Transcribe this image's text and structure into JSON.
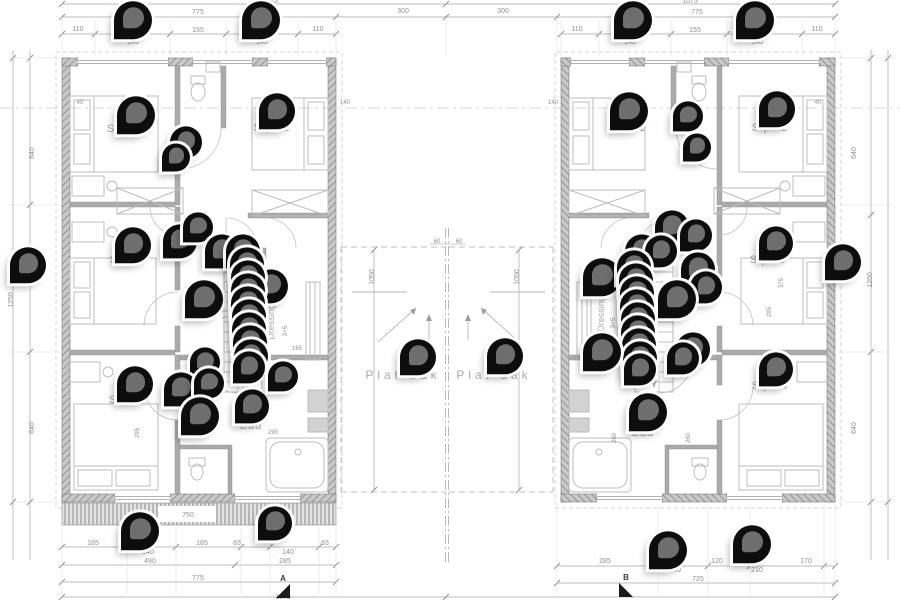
{
  "drawing": {
    "type_label": "first-floor plan, two mirrored dwelling units",
    "colors": {
      "pin_body": "#0d0d0d",
      "pin_inner": "#6e6e6e",
      "wall": "#a8a8a8",
      "dim_text": "#8f8f8f"
    }
  },
  "texts": [
    {
      "x": 270,
      "y": 3,
      "t": "1075",
      "n": "dim-total-left"
    },
    {
      "x": 690,
      "y": 3,
      "t": "1075",
      "n": "dim-total-right"
    },
    {
      "x": 198,
      "y": 14,
      "t": "775"
    },
    {
      "x": 403,
      "y": 13,
      "t": "300"
    },
    {
      "x": 503,
      "y": 13,
      "t": "300"
    },
    {
      "x": 697,
      "y": 14,
      "t": "775"
    },
    {
      "x": 78,
      "y": 31,
      "t": "110"
    },
    {
      "x": 198,
      "y": 32,
      "t": "155"
    },
    {
      "x": 318,
      "y": 31,
      "t": "110"
    },
    {
      "x": 133,
      "y": 44,
      "t": "140"
    },
    {
      "x": 262,
      "y": 44,
      "t": "140"
    },
    {
      "x": 577,
      "y": 31,
      "t": "110"
    },
    {
      "x": 695,
      "y": 32,
      "t": "155"
    },
    {
      "x": 817,
      "y": 31,
      "t": "110"
    },
    {
      "x": 630,
      "y": 44,
      "t": "140"
    },
    {
      "x": 757,
      "y": 44,
      "t": "140"
    },
    {
      "x": 80,
      "y": 104,
      "t": "40",
      "s": 6
    },
    {
      "x": 345,
      "y": 104,
      "t": "140",
      "s": 6
    },
    {
      "x": 553,
      "y": 104,
      "t": "140",
      "s": 6
    },
    {
      "x": 818,
      "y": 104,
      "t": "40",
      "s": 6
    },
    {
      "x": 437,
      "y": 243,
      "t": "60",
      "s": 6
    },
    {
      "x": 459,
      "y": 243,
      "t": "60",
      "s": 6
    },
    {
      "x": 125,
      "y": 132,
      "t": "Slpk.2",
      "s": 11,
      "ls": 1,
      "c": "#a9a9a9",
      "n": "room-label-slpk2-left"
    },
    {
      "x": 272,
      "y": 131,
      "t": "Slpk.1",
      "s": 11,
      "ls": 1,
      "c": "#a9a9a9",
      "n": "room-label-slpk1-left"
    },
    {
      "x": 128,
      "y": 263,
      "t": "Slpk.3",
      "s": 11,
      "ls": 1,
      "c": "#a9a9a9",
      "n": "room-label-slpk3-left"
    },
    {
      "x": 127,
      "y": 403,
      "t": "Slpk.4",
      "s": 11,
      "ls": 1,
      "c": "#a9a9a9",
      "n": "room-label-slpk4-left"
    },
    {
      "x": 251,
      "y": 429,
      "t": "Bad",
      "s": 11,
      "ls": 1,
      "c": "#a9a9a9",
      "n": "room-label-bad-left"
    },
    {
      "x": 274,
      "y": 322,
      "t": "Dressing",
      "s": 9,
      "r": -90,
      "c": "#a9a9a9",
      "n": "room-label-dressing-left"
    },
    {
      "x": 287,
      "y": 331,
      "t": "3+5",
      "s": 6.5,
      "r": -90
    },
    {
      "x": 628,
      "y": 131,
      "t": "Slpk.1",
      "s": 11,
      "ls": 1,
      "c": "#a9a9a9",
      "n": "room-label-slpk1-right"
    },
    {
      "x": 770,
      "y": 131,
      "t": "Slpk.2",
      "s": 11,
      "ls": 1,
      "c": "#a9a9a9",
      "n": "room-label-slpk2-right"
    },
    {
      "x": 768,
      "y": 263,
      "t": "Slpk.3",
      "s": 11,
      "ls": 1,
      "c": "#a9a9a9",
      "n": "room-label-slpk3-right"
    },
    {
      "x": 770,
      "y": 389,
      "t": "Slpk.4",
      "s": 11,
      "ls": 1,
      "c": "#a9a9a9",
      "n": "room-label-slpk4-right"
    },
    {
      "x": 643,
      "y": 436,
      "t": "Bad",
      "s": 11,
      "ls": 1,
      "c": "#a9a9a9",
      "n": "room-label-bad-right"
    },
    {
      "x": 604,
      "y": 314,
      "t": "Dressing",
      "s": 9,
      "r": -90,
      "c": "#a9a9a9",
      "n": "room-label-dressing-right"
    },
    {
      "x": 615,
      "y": 323,
      "t": "3+5",
      "s": 6.5,
      "r": -90
    },
    {
      "x": 403,
      "y": 379,
      "t": "Plat dak",
      "s": 12,
      "ls": 4,
      "c": "#ababab",
      "n": "flat-roof-label-left"
    },
    {
      "x": 494,
      "y": 379,
      "t": "Plat dak",
      "s": 12,
      "ls": 4,
      "c": "#ababab",
      "n": "flat-roof-label-right"
    },
    {
      "x": 188,
      "y": 517,
      "t": "750",
      "s": 7
    },
    {
      "x": 93,
      "y": 545,
      "t": "185"
    },
    {
      "x": 148,
      "y": 554,
      "t": "140"
    },
    {
      "x": 202,
      "y": 545,
      "t": "185"
    },
    {
      "x": 237,
      "y": 545,
      "t": "83"
    },
    {
      "x": 288,
      "y": 554,
      "t": "140"
    },
    {
      "x": 325,
      "y": 545,
      "t": "83"
    },
    {
      "x": 150,
      "y": 563,
      "t": "490"
    },
    {
      "x": 285,
      "y": 563,
      "t": "285"
    },
    {
      "x": 198,
      "y": 580,
      "t": "775"
    },
    {
      "x": 605,
      "y": 563,
      "t": "285"
    },
    {
      "x": 675,
      "y": 572,
      "t": "140"
    },
    {
      "x": 717,
      "y": 563,
      "t": "120"
    },
    {
      "x": 757,
      "y": 572,
      "t": "210"
    },
    {
      "x": 806,
      "y": 563,
      "t": "170"
    },
    {
      "x": 698,
      "y": 581,
      "t": "725"
    },
    {
      "x": 283,
      "y": 599,
      "t": "1075"
    },
    {
      "x": 13,
      "y": 300,
      "t": "1250",
      "r": -90
    },
    {
      "x": 34,
      "y": 153,
      "t": "640",
      "r": -90
    },
    {
      "x": 34,
      "y": 428,
      "t": "640",
      "r": -90
    },
    {
      "x": 872,
      "y": 280,
      "t": "1250",
      "r": -90
    },
    {
      "x": 856,
      "y": 153,
      "t": "640",
      "r": -90
    },
    {
      "x": 856,
      "y": 428,
      "t": "640",
      "r": -90
    },
    {
      "x": 374,
      "y": 277,
      "t": "1050",
      "r": -90
    },
    {
      "x": 519,
      "y": 277,
      "t": "1050",
      "r": -90
    },
    {
      "x": 139,
      "y": 433,
      "t": "295",
      "r": -90,
      "s": 6
    },
    {
      "x": 771,
      "y": 312,
      "t": "295",
      "r": -90,
      "s": 6
    },
    {
      "x": 783,
      "y": 283,
      "t": "375",
      "r": -90,
      "s": 6
    },
    {
      "x": 616,
      "y": 438,
      "t": "260",
      "r": -90,
      "s": 6
    },
    {
      "x": 690,
      "y": 438,
      "t": "260",
      "r": -90,
      "s": 6
    },
    {
      "x": 297,
      "y": 350,
      "t": "165",
      "s": 6
    },
    {
      "x": 273,
      "y": 434,
      "t": "290",
      "s": 6
    },
    {
      "x": 642,
      "y": 398,
      "t": "390",
      "s": 6
    }
  ],
  "sections": [
    {
      "label": "A",
      "x": 283,
      "y": 581,
      "tri": "290,584 290,598 276,598"
    },
    {
      "label": "B",
      "x": 626,
      "y": 580,
      "tri": "619,583 633,597 619,597"
    }
  ],
  "pins": [
    [
      133,
      21,
      38
    ],
    [
      261,
      21,
      38
    ],
    [
      633,
      21,
      38
    ],
    [
      755,
      21,
      38
    ],
    [
      136,
      116,
      38
    ],
    [
      277,
      112,
      36
    ],
    [
      186,
      143,
      32
    ],
    [
      176,
      158,
      28
    ],
    [
      629,
      112,
      38
    ],
    [
      777,
      110,
      36
    ],
    [
      688,
      117,
      30
    ],
    [
      697,
      148,
      28
    ],
    [
      28,
      266,
      36
    ],
    [
      843,
      263,
      36
    ],
    [
      133,
      246,
      36
    ],
    [
      180,
      242,
      34
    ],
    [
      198,
      228,
      30
    ],
    [
      222,
      252,
      34
    ],
    [
      271,
      287,
      34
    ],
    [
      204,
      300,
      38
    ],
    [
      243,
      252,
      34
    ],
    [
      247,
      265,
      34
    ],
    [
      248,
      278,
      34
    ],
    [
      248,
      291,
      34
    ],
    [
      248,
      304,
      34
    ],
    [
      249,
      317,
      34
    ],
    [
      249,
      330,
      34
    ],
    [
      250,
      343,
      34
    ],
    [
      251,
      357,
      34
    ],
    [
      249,
      368,
      32
    ],
    [
      205,
      363,
      30
    ],
    [
      135,
      385,
      36
    ],
    [
      181,
      390,
      34
    ],
    [
      209,
      384,
      30
    ],
    [
      200,
      417,
      38
    ],
    [
      252,
      407,
      34
    ],
    [
      283,
      377,
      30
    ],
    [
      418,
      358,
      36
    ],
    [
      505,
      357,
      36
    ],
    [
      672,
      228,
      34
    ],
    [
      696,
      236,
      32
    ],
    [
      642,
      252,
      34
    ],
    [
      661,
      252,
      32
    ],
    [
      602,
      278,
      38
    ],
    [
      698,
      270,
      34
    ],
    [
      706,
      288,
      32
    ],
    [
      677,
      300,
      38
    ],
    [
      634,
      268,
      34
    ],
    [
      636,
      281,
      34
    ],
    [
      637,
      294,
      34
    ],
    [
      637,
      307,
      34
    ],
    [
      638,
      320,
      34
    ],
    [
      638,
      333,
      34
    ],
    [
      639,
      346,
      34
    ],
    [
      640,
      359,
      34
    ],
    [
      640,
      370,
      32
    ],
    [
      602,
      353,
      38
    ],
    [
      693,
      350,
      34
    ],
    [
      683,
      359,
      32
    ],
    [
      648,
      413,
      38
    ],
    [
      776,
      244,
      34
    ],
    [
      776,
      370,
      34
    ],
    [
      140,
      532,
      38
    ],
    [
      275,
      524,
      34
    ],
    [
      668,
      551,
      38
    ],
    [
      752,
      545,
      38
    ]
  ]
}
